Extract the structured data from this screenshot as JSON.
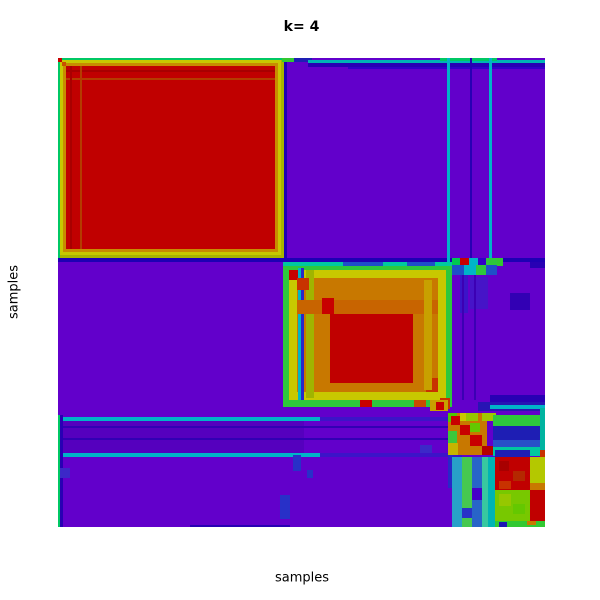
{
  "chart_data": {
    "type": "heatmap",
    "title": "k= 4",
    "xlabel": "samples",
    "ylabel": "samples",
    "legend": "none",
    "grid": false,
    "k": 4,
    "colormap": "rainbow: purple=low consensus (~0), blue~0.2, cyan~0.4, green~0.55, yellow~0.7, orange~0.85, red=high consensus (~1)",
    "color_scale": {
      "low": "#6200CB",
      "blue": "#2800B4",
      "cyan": "#00B4C8",
      "green": "#2EC83C",
      "yellow": "#C8C800",
      "orange": "#C87800",
      "high": "#C00000"
    },
    "clusters": [
      {
        "id": 1,
        "approx_fraction": 0.46,
        "appearance": "large solid red block, top-left, consensus ~1, thin green/yellow/orange gradient border"
      },
      {
        "id": 2,
        "approx_fraction": 0.35,
        "appearance": "red core with orange/yellow rings and green/cyan fringe, middle of diagonal"
      },
      {
        "id": 3,
        "approx_fraction": 0.08,
        "appearance": "small unstable block, mixed red/orange/green mosaic, cyan cross-stripes with cluster 1"
      },
      {
        "id": 4,
        "approx_fraction": 0.11,
        "appearance": "two small high-consensus red sub-blocks in bottom-right with green/blue mixed cross terms"
      }
    ],
    "plot_area_px": {
      "left": 58,
      "top": 58,
      "width": 487,
      "height": 469
    },
    "background_color": "#6200CB",
    "rects": [
      [
        0,
        0,
        226,
        200,
        "#A8B400"
      ],
      [
        0,
        0,
        226,
        2,
        "#00C864"
      ],
      [
        0,
        0,
        2,
        200,
        "#00C864"
      ],
      [
        2,
        2,
        221,
        195,
        "#C8C800"
      ],
      [
        5,
        5,
        215,
        189,
        "#C88C00"
      ],
      [
        8,
        8,
        209,
        183,
        "#C00000"
      ],
      [
        8,
        12,
        209,
        2,
        "#A80000"
      ],
      [
        8,
        20,
        209,
        2,
        "#B43C00"
      ],
      [
        12,
        8,
        2,
        183,
        "#A80000"
      ],
      [
        22,
        8,
        2,
        183,
        "#B43C00"
      ],
      [
        0,
        0,
        4,
        4,
        "#C80000"
      ],
      [
        4,
        4,
        4,
        4,
        "#C85000"
      ],
      [
        226,
        0,
        3,
        204,
        "#1E00B4"
      ],
      [
        0,
        200,
        487,
        4,
        "#1E00B4"
      ],
      [
        224,
        0,
        12,
        4,
        "#32C832"
      ],
      [
        236,
        0,
        18,
        4,
        "#1E1EB4"
      ],
      [
        250,
        2,
        237,
        3,
        "#00B4B4"
      ],
      [
        250,
        5,
        237,
        4,
        "#2800B4"
      ],
      [
        290,
        9,
        197,
        2,
        "#3200C8"
      ],
      [
        382,
        0,
        57,
        3,
        "#00C864"
      ],
      [
        389,
        0,
        3,
        204,
        "#00B4C8"
      ],
      [
        431,
        0,
        3,
        204,
        "#00B4C8"
      ],
      [
        412,
        0,
        2,
        204,
        "#2800B4"
      ],
      [
        225,
        204,
        169,
        145,
        "#2EC83C"
      ],
      [
        225,
        204,
        169,
        4,
        "#00C8A0"
      ],
      [
        285,
        204,
        40,
        4,
        "#1E50C8"
      ],
      [
        349,
        204,
        28,
        4,
        "#1E50C8"
      ],
      [
        231,
        212,
        157,
        130,
        "#C8C800"
      ],
      [
        231,
        212,
        10,
        10,
        "#C80000"
      ],
      [
        239,
        220,
        141,
        114,
        "#C87800"
      ],
      [
        272,
        255,
        83,
        70,
        "#C00000"
      ],
      [
        240,
        210,
        3,
        132,
        "#00B4C8"
      ],
      [
        243,
        210,
        3,
        132,
        "#2828C8"
      ],
      [
        248,
        212,
        8,
        128,
        "#A0B400"
      ],
      [
        239,
        242,
        141,
        14,
        "#C86400"
      ],
      [
        264,
        240,
        12,
        16,
        "#C80000"
      ],
      [
        239,
        220,
        12,
        12,
        "#C83200"
      ],
      [
        368,
        320,
        12,
        14,
        "#C83200"
      ],
      [
        366,
        222,
        8,
        110,
        "#C8A000"
      ],
      [
        302,
        342,
        12,
        7,
        "#C80000"
      ],
      [
        356,
        342,
        12,
        7,
        "#C84B00"
      ],
      [
        394,
        200,
        8,
        7,
        "#00C850"
      ],
      [
        402,
        200,
        9,
        7,
        "#C80000"
      ],
      [
        411,
        200,
        9,
        7,
        "#00B4C8"
      ],
      [
        420,
        200,
        8,
        7,
        "#3200C8"
      ],
      [
        428,
        200,
        11,
        7,
        "#2EC83C"
      ],
      [
        394,
        207,
        12,
        10,
        "#1E50C8"
      ],
      [
        406,
        207,
        12,
        10,
        "#00B4C8"
      ],
      [
        418,
        207,
        10,
        10,
        "#2EC83C"
      ],
      [
        428,
        207,
        11,
        10,
        "#1E50C8"
      ],
      [
        472,
        204,
        15,
        6,
        "#2800B4"
      ],
      [
        439,
        200,
        6,
        8,
        "#32C832"
      ],
      [
        402,
        217,
        8,
        38,
        "#3C14C8"
      ],
      [
        412,
        219,
        18,
        32,
        "#4614C8"
      ],
      [
        452,
        235,
        20,
        17,
        "#3200B4"
      ],
      [
        404,
        217,
        2,
        125,
        "#3C00B4"
      ],
      [
        416,
        217,
        2,
        125,
        "#3C00B4"
      ],
      [
        432,
        337,
        55,
        10,
        "#2800B4"
      ],
      [
        420,
        344,
        67,
        9,
        "#2814B4"
      ],
      [
        432,
        347,
        55,
        4,
        "#00B4C8"
      ],
      [
        382,
        340,
        10,
        11,
        "#C83200"
      ],
      [
        0,
        362,
        246,
        33,
        "#5500BE"
      ],
      [
        0,
        368,
        404,
        2,
        "#3200B4"
      ],
      [
        0,
        380,
        404,
        2,
        "#3200B4"
      ],
      [
        0,
        359,
        262,
        4,
        "#00B4C8"
      ],
      [
        262,
        359,
        142,
        4,
        "#3C14C8"
      ],
      [
        0,
        395,
        262,
        4,
        "#00B4C8"
      ],
      [
        262,
        395,
        142,
        4,
        "#3C14C8"
      ],
      [
        0,
        357,
        2,
        112,
        "#00C864"
      ],
      [
        2,
        357,
        3,
        112,
        "#2800B4"
      ],
      [
        2,
        410,
        10,
        10,
        "#3C28C8"
      ],
      [
        235,
        397,
        8,
        16,
        "#2830C8"
      ],
      [
        249,
        412,
        6,
        8,
        "#2830C8"
      ],
      [
        222,
        437,
        10,
        24,
        "#2830C8"
      ],
      [
        132,
        467,
        100,
        2,
        "#2800B4"
      ],
      [
        362,
        387,
        12,
        8,
        "#3C28C8"
      ],
      [
        372,
        342,
        18,
        11,
        "#C8A000"
      ],
      [
        378,
        344,
        8,
        8,
        "#C80000"
      ],
      [
        390,
        355,
        39,
        42,
        "#C87800"
      ],
      [
        390,
        355,
        9,
        9,
        "#50C800"
      ],
      [
        408,
        355,
        12,
        8,
        "#96C800"
      ],
      [
        390,
        373,
        9,
        12,
        "#3CC83C"
      ],
      [
        412,
        365,
        10,
        9,
        "#64C800"
      ],
      [
        402,
        355,
        6,
        8,
        "#C8C800"
      ],
      [
        390,
        385,
        10,
        12,
        "#C8B400"
      ],
      [
        424,
        355,
        14,
        8,
        "#A0C800"
      ],
      [
        393,
        358,
        9,
        9,
        "#C80000"
      ],
      [
        402,
        367,
        10,
        10,
        "#C80000"
      ],
      [
        412,
        377,
        12,
        11,
        "#C80000"
      ],
      [
        424,
        388,
        14,
        9,
        "#B40000"
      ],
      [
        435,
        357,
        47,
        11,
        "#2EC83C"
      ],
      [
        435,
        368,
        47,
        14,
        "#1E1EB4"
      ],
      [
        435,
        382,
        47,
        7,
        "#2850C8"
      ],
      [
        435,
        389,
        47,
        9,
        "#00C8A0"
      ],
      [
        482,
        350,
        5,
        49,
        "#00B4A0"
      ],
      [
        482,
        392,
        5,
        7,
        "#C83200"
      ],
      [
        390,
        397,
        5,
        33,
        "#2828C8"
      ],
      [
        394,
        399,
        10,
        70,
        "#28A0C8"
      ],
      [
        404,
        399,
        10,
        70,
        "#46C850"
      ],
      [
        414,
        399,
        10,
        70,
        "#2864C8"
      ],
      [
        424,
        399,
        6,
        70,
        "#38C8A0"
      ],
      [
        414,
        430,
        10,
        12,
        "#4600C8"
      ],
      [
        404,
        450,
        10,
        10,
        "#2832C8"
      ],
      [
        430,
        399,
        7,
        70,
        "#00B4B4"
      ],
      [
        437,
        392,
        35,
        7,
        "#1E1EB4"
      ],
      [
        437,
        399,
        35,
        33,
        "#C00000"
      ],
      [
        441,
        403,
        10,
        10,
        "#A80000"
      ],
      [
        455,
        413,
        12,
        10,
        "#B42800"
      ],
      [
        441,
        423,
        12,
        8,
        "#C83200"
      ],
      [
        472,
        399,
        15,
        26,
        "#B4C800"
      ],
      [
        472,
        425,
        15,
        7,
        "#C87800"
      ],
      [
        437,
        432,
        35,
        31,
        "#78C800"
      ],
      [
        441,
        436,
        12,
        12,
        "#96C800"
      ],
      [
        455,
        446,
        12,
        10,
        "#64C800"
      ],
      [
        472,
        432,
        15,
        31,
        "#C00000"
      ],
      [
        437,
        463,
        50,
        6,
        "#32C832"
      ],
      [
        469,
        463,
        9,
        4,
        "#C87800"
      ],
      [
        441,
        464,
        8,
        5,
        "#1E14B4"
      ]
    ]
  }
}
